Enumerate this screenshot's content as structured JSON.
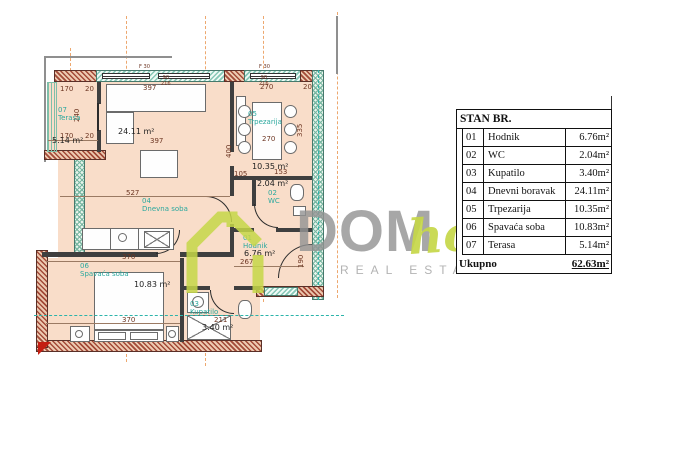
{
  "table": {
    "header": "STAN BR.",
    "rows": [
      {
        "num": "01",
        "name": "Hodnik",
        "area": "6.76m²"
      },
      {
        "num": "02",
        "name": "WC",
        "area": "2.04m²"
      },
      {
        "num": "03",
        "name": "Kupatilo",
        "area": "3.40m²"
      },
      {
        "num": "04",
        "name": "Dnevni boravak",
        "area": "24.11m²"
      },
      {
        "num": "05",
        "name": "Trpezarija",
        "area": "10.35m²"
      },
      {
        "num": "06",
        "name": "Spavaća soba",
        "area": "10.83m²"
      },
      {
        "num": "07",
        "name": "Terasa",
        "area": "5.14m²"
      }
    ],
    "total_label": "Ukupno",
    "total_area": "62.63m²"
  },
  "logo": {
    "dom": "DOM",
    "home": "home",
    "tagline": "REAL ESTATE",
    "accent_color": "#c6d748",
    "gray_color": "#949494"
  },
  "plan": {
    "rooms": [
      {
        "num": "07",
        "name": "Terasa",
        "area": "5.14 m²"
      },
      {
        "num": "04",
        "name": "Dnevna soba",
        "area": "24.11 m²"
      },
      {
        "num": "05",
        "name": "Trpezarija",
        "area": "10.35 m²"
      },
      {
        "num": "02",
        "name": "WC",
        "area": "2.04 m²"
      },
      {
        "num": "01",
        "name": "Hodnik",
        "area": "6.76 m²"
      },
      {
        "num": "03",
        "name": "Kupatilo",
        "area": "3.40 m²"
      },
      {
        "num": "06",
        "name": "Spavaća soba",
        "area": "10.83 m²"
      }
    ],
    "dims": [
      "170",
      "20",
      "240",
      "170",
      "20",
      "397",
      "397",
      "527",
      "270",
      "20",
      "270",
      "335",
      "400",
      "153",
      "267",
      "190",
      "370",
      "370",
      "211",
      "105",
      "90",
      "216",
      "90",
      "216",
      "F 30",
      "F 30"
    ],
    "colors": {
      "floor": "#f9ddc9",
      "wall_hatch": "#a34a38",
      "window_hatch": "#86c7b6",
      "room_name": "#2ba89e",
      "dimension_text": "#6d3623",
      "grid_line": "#eda86f",
      "section_line": "#2cb4aa"
    }
  }
}
